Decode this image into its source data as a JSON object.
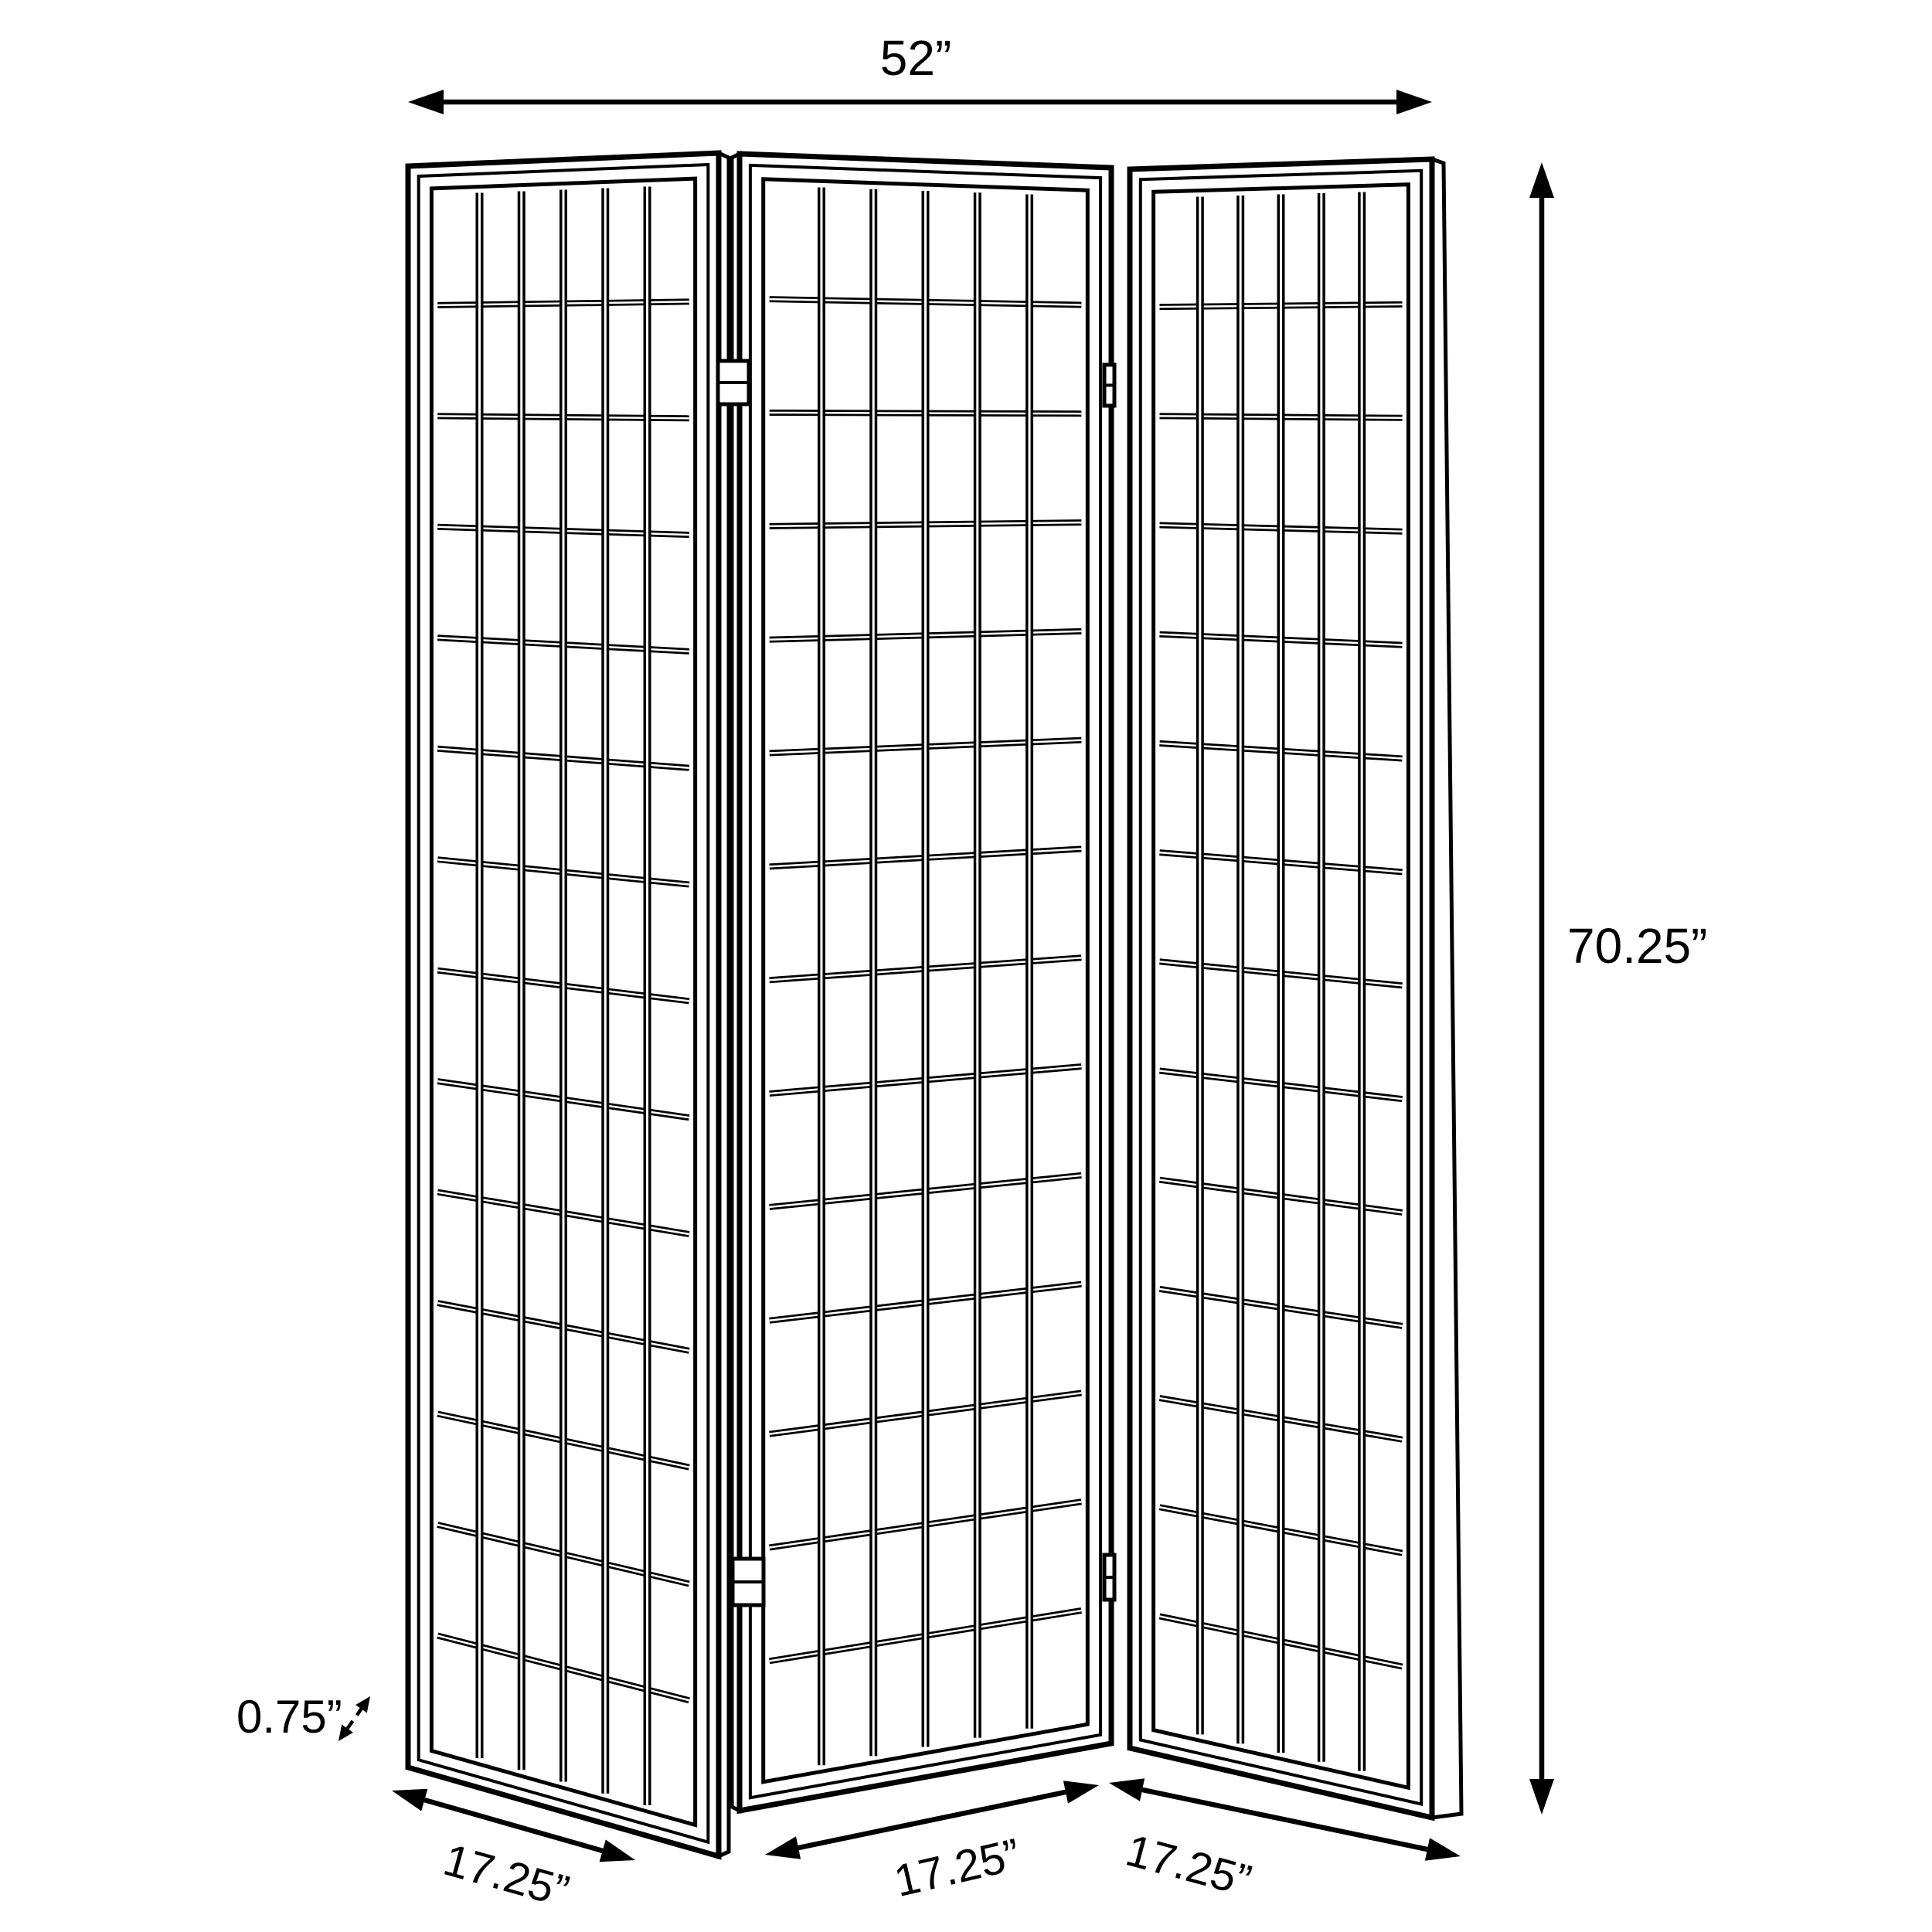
{
  "diagram": {
    "subject": "3-panel folding screen room divider dimension drawing",
    "style": {
      "line_color": "#000000",
      "background_color": "#ffffff"
    },
    "panels": {
      "count": 3,
      "grid_columns": 6,
      "grid_rows": 14
    },
    "dimensions": {
      "overall_width": "52”",
      "overall_height": "70.25”",
      "panel_widths": [
        "17.25”",
        "17.25”",
        "17.25”"
      ],
      "frame_thickness": "0.75”"
    }
  }
}
